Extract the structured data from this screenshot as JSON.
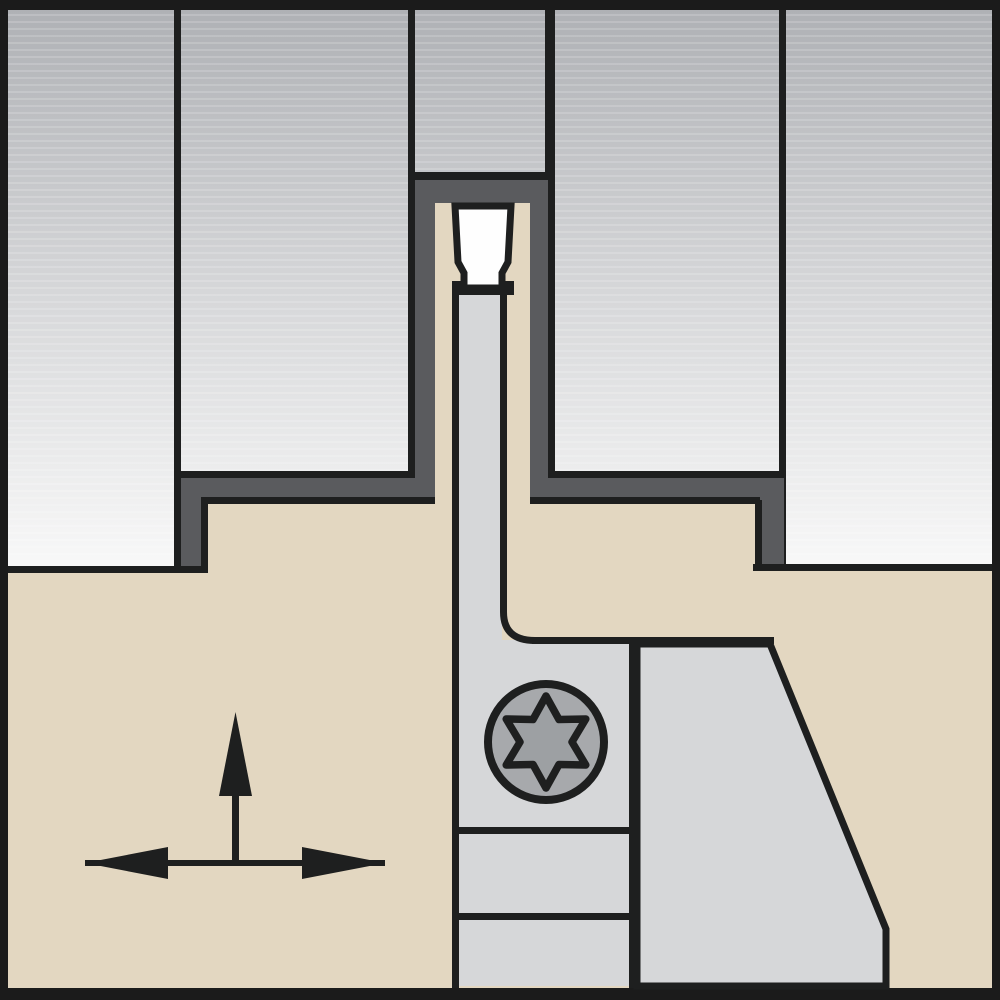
{
  "figure": {
    "alt": "Cross-section technical illustration of a grooving/parting tool: workpiece with machined groove, white cutting insert on a blade, holder body with Torx clamp screw and feed-direction arrows"
  },
  "colors": {
    "frame": "#1b1b1b",
    "line": "#1e1f1f",
    "holder_tan": "#e3d7c1",
    "slot_dark": "#5a5b5e",
    "steel_light": "#d6d7d9",
    "insert_white": "#fefefe",
    "screw_head": "#a7a9ac",
    "screw_star": "#9da0a3",
    "grad_top": "#afb1b5",
    "grad_mid": "#d6d7d9",
    "grad_bottom": "#f9f9f9"
  },
  "icons": [
    {
      "name": "torx-screw-icon",
      "glyph": "six-lobe star in circle"
    },
    {
      "name": "up-arrow-icon",
      "glyph": "filled triangle arrow pointing up"
    },
    {
      "name": "left-right-arrow-icon",
      "glyph": "double-headed horizontal arrow"
    }
  ]
}
